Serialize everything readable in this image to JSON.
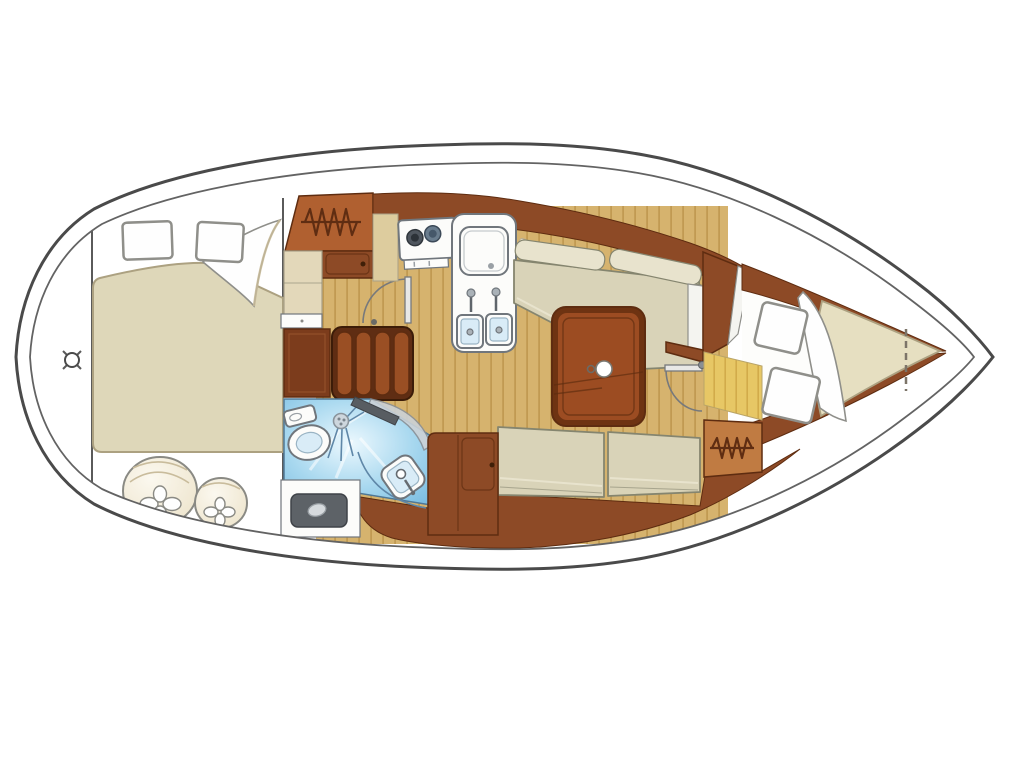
{
  "title": "Sailboat interior layout floor plan, top view, bow pointing right",
  "canvas": {
    "width": 1024,
    "height": 768,
    "background": "#ffffff"
  },
  "areas": [
    {
      "id": "transom",
      "label": "stern transom area with position marker"
    },
    {
      "id": "aft-cabin",
      "label": "aft double berth cabin with two pillows"
    },
    {
      "id": "aft-stowage",
      "label": "stern stowage with two round fenders"
    },
    {
      "id": "companionway",
      "label": "companionway steps and lockers"
    },
    {
      "id": "galley",
      "label": "galley with two-burner stove, icebox and double sink"
    },
    {
      "id": "salon",
      "label": "salon with L-settee, table and straight settee"
    },
    {
      "id": "head",
      "label": "wet head with toilet, shower and washbasin"
    },
    {
      "id": "fwd-cabin",
      "label": "forward V-berth cabin with two pillows"
    }
  ],
  "icons": {
    "hanger": "zigzag-clothes-hanger-icon",
    "shower": "shower-rose-with-spray-icon",
    "crosshair": "position-crosshair-icon",
    "fender": "round-fender-with-clover-knot-icon"
  },
  "colors": {
    "hull_outline": "#4a4a4a",
    "hull_inner_line": "#636363",
    "hull_fill": "#ffffff",
    "bulkhead_line": "#5a5a5a",
    "floor": "#d6b36e",
    "floor_stripe": "#c19a52",
    "floor_fwd": "#e7c765",
    "floor_fwd_stripe": "#d2ab4a",
    "wood": "#8d4a26",
    "wood_panel": "#7c3c1c",
    "wood_light": "#9a4f24",
    "wood_outline": "#5e2c10",
    "table_border": "#6e3312",
    "table_top": "#9c4c22",
    "locker": "#b06030",
    "locker_fwd": "#c07b42",
    "locker_icon": "#5f2d12",
    "cushion": "#d9d3b8",
    "cushion_light": "#e8e3cd",
    "cushion_outline": "#85856f",
    "bed": "#ded7b9",
    "bed_fwd": "#e6dfc1",
    "bed_outline": "#aca181",
    "pillow": "#fefefe",
    "pillow_outline": "#8f8f8a",
    "head_blue_edge": "#6fb6de",
    "head_blue_mid": "#a8d8ef",
    "head_blue_light": "#ecf8fe",
    "spray_line": "#5f87a8",
    "fixture_white": "#fcfcfa",
    "fixture_outline": "#70767c",
    "fixture_inner": "#d9ecf7",
    "fixture_inner_edge": "#9ab4c4",
    "metal": "#aab2b8",
    "burner_dark": "#4f565e",
    "burner_blue": "#6a7d8e",
    "hatch_gray": "#5d6267",
    "hatch_gray_dark": "#3f4348",
    "door_line": "#77797c",
    "door_leaf": "#e8e8e6",
    "door_panel": "#ccd2d7",
    "beige_locker": "#e3d8ba",
    "beige_strip": "#ddcc9e",
    "beige_outline": "#a9a188",
    "white_panel": "#f4f4f0",
    "fender": "#ece2c8",
    "fender_hi": "#fbf8ef",
    "fender_outline": "#8a8a84",
    "fender_shade": "#c9bc9c",
    "marker": "#4a4a4a",
    "plaque": "#f0ead8"
  }
}
